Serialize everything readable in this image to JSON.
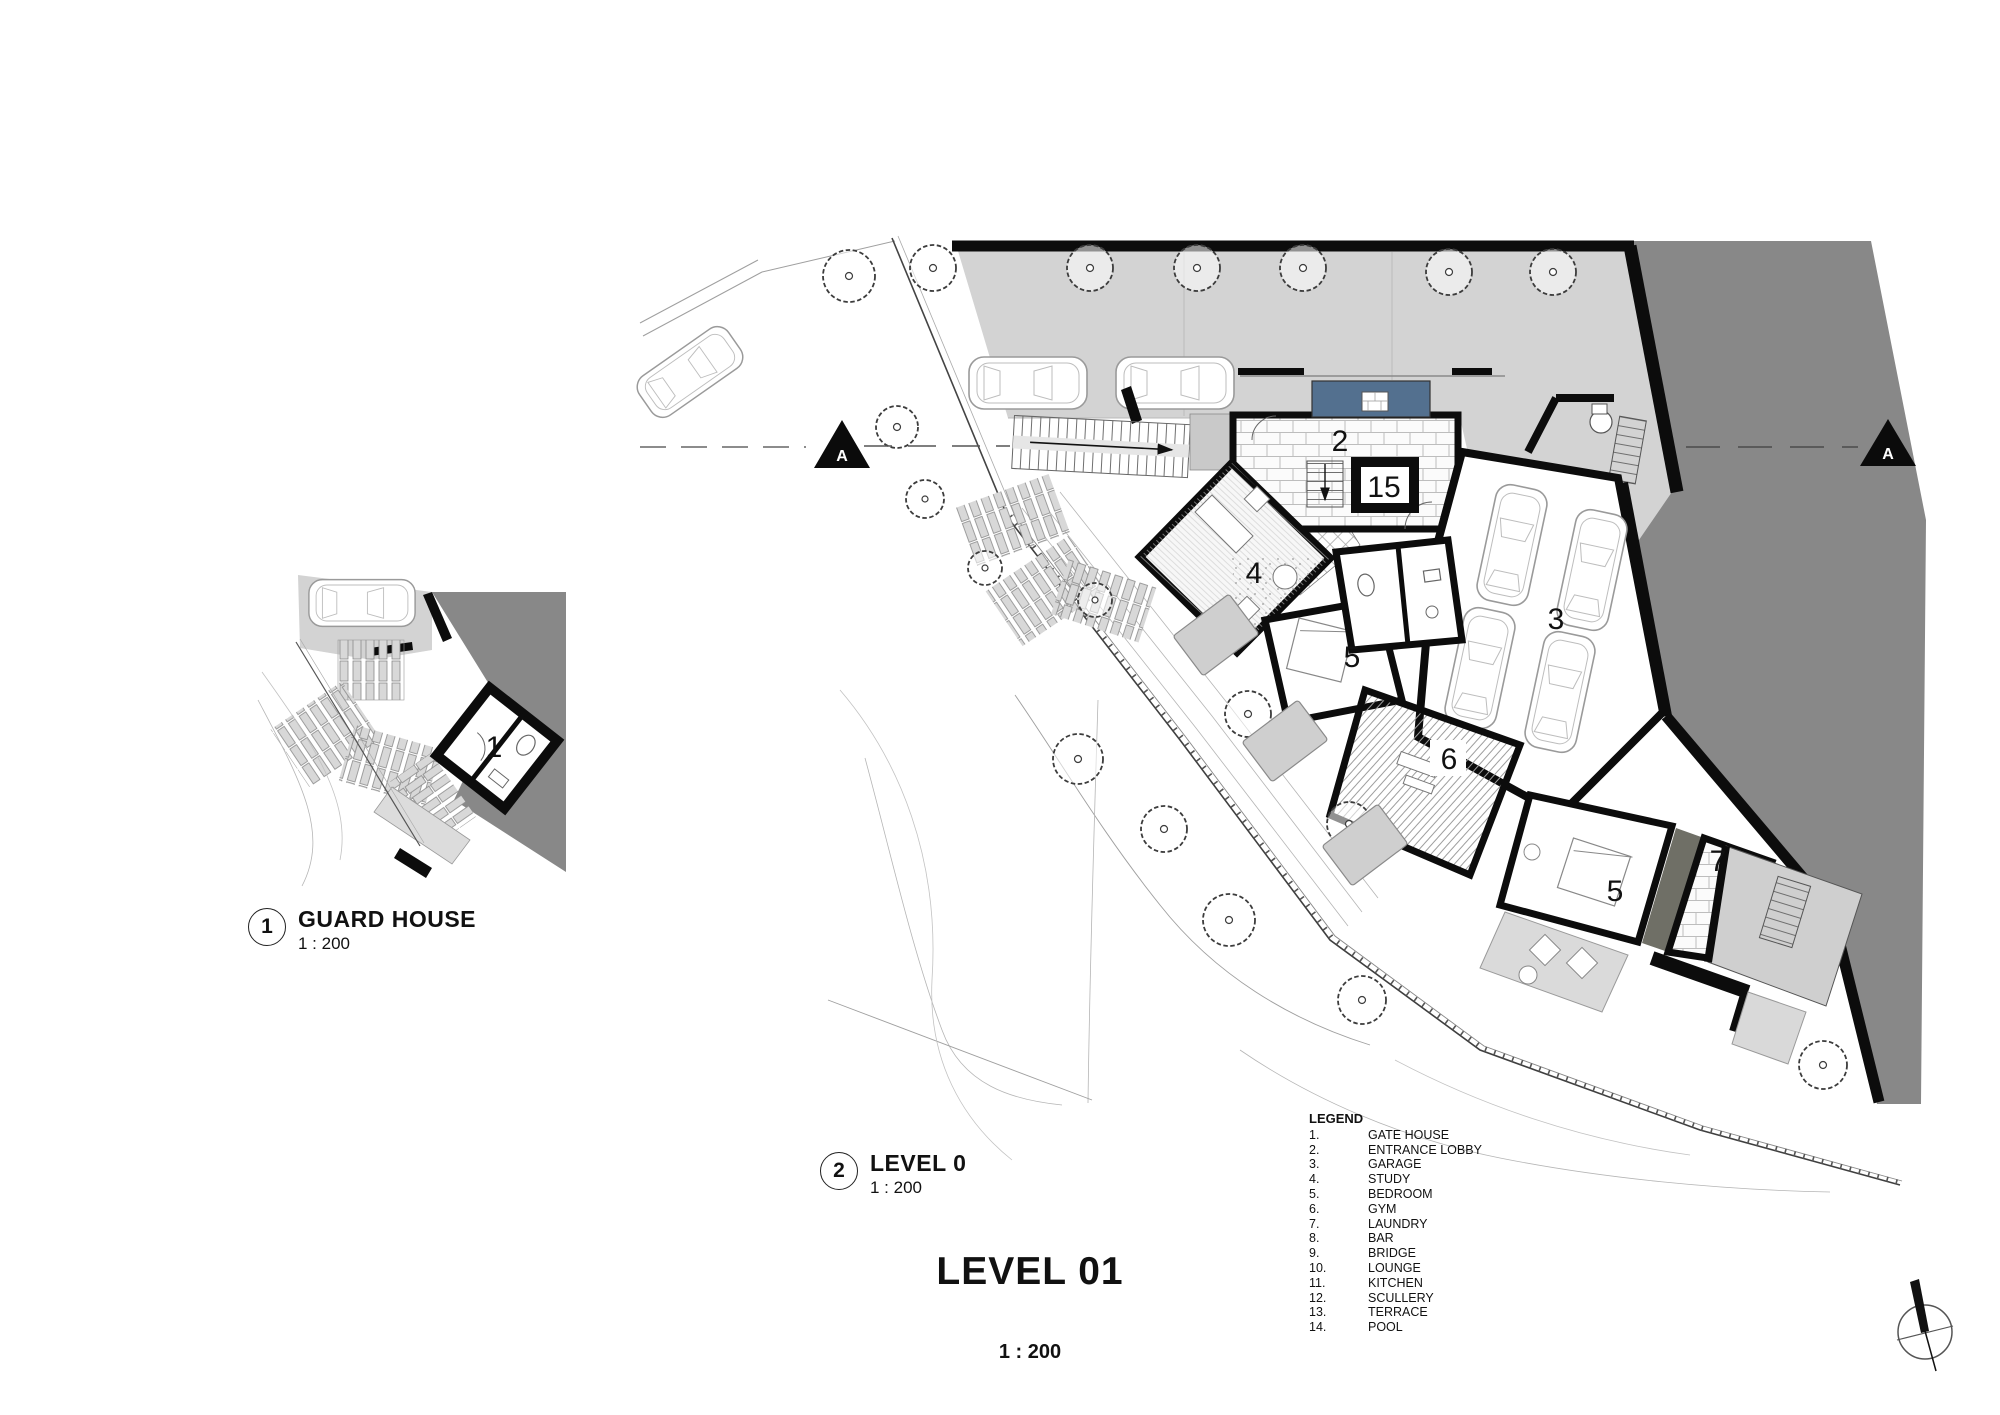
{
  "sheet": {
    "title": "LEVEL 01",
    "scale": "1 : 200"
  },
  "views": {
    "guard_house": {
      "number": "1",
      "title": "GUARD HOUSE",
      "scale": "1 : 200"
    },
    "level_0": {
      "number": "2",
      "title": "LEVEL 0",
      "scale": "1 : 200"
    }
  },
  "section": {
    "label_left": "A",
    "label_right": "A"
  },
  "rooms": {
    "gate_house": "1",
    "entrance_lobby": "2",
    "stair_core": "15",
    "garage": "3",
    "study": "4",
    "bedroom": "5",
    "gym": "6",
    "laundry": "7",
    "bedroom_2": "5"
  },
  "legend": {
    "heading": "LEGEND",
    "items": [
      {
        "num": "1.",
        "name": "GATE HOUSE"
      },
      {
        "num": "2.",
        "name": "ENTRANCE LOBBY"
      },
      {
        "num": "3.",
        "name": "GARAGE"
      },
      {
        "num": "4.",
        "name": "STUDY"
      },
      {
        "num": "5.",
        "name": "BEDROOM"
      },
      {
        "num": "6.",
        "name": "GYM"
      },
      {
        "num": "7.",
        "name": "LAUNDRY"
      },
      {
        "num": "8.",
        "name": "BAR"
      },
      {
        "num": "9.",
        "name": "BRIDGE"
      },
      {
        "num": "10.",
        "name": "LOUNGE"
      },
      {
        "num": "11.",
        "name": "KITCHEN"
      },
      {
        "num": "12.",
        "name": "SCULLERY"
      },
      {
        "num": "13.",
        "name": "TERRACE"
      },
      {
        "num": "14.",
        "name": "POOL"
      }
    ]
  },
  "colors": {
    "neighbor_gray": "#888888",
    "parking_gray": "#d3d3d3",
    "water_blue": "#53708f",
    "terrace_band": "#6f6f66"
  }
}
